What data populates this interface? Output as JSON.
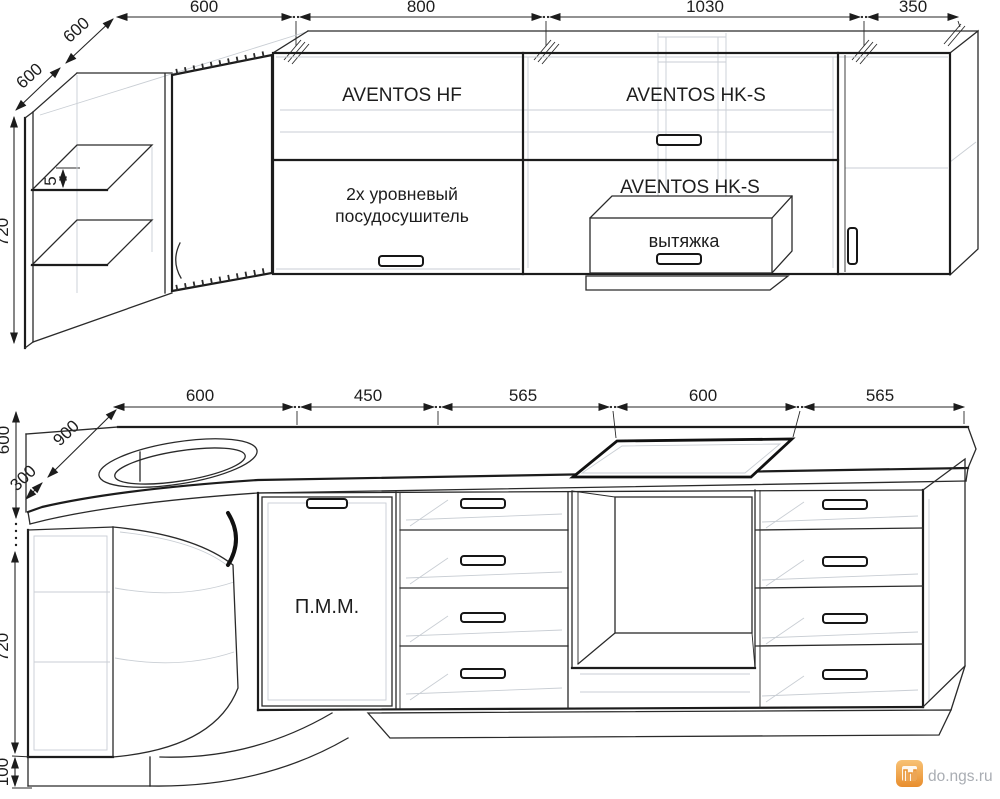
{
  "title": "Kitchen cabinets dimensioned drawing",
  "colors": {
    "line": "#1c1c1c",
    "ghost": "#c9ced4",
    "background": "#ffffff",
    "watermark_orange": "#ec9a3c",
    "watermark_text": "#a9adb3"
  },
  "upper": {
    "dim_top": [
      "600",
      "800",
      "1030",
      "350"
    ],
    "dim_depth": [
      "600",
      "600"
    ],
    "dim_left": {
      "height": "720",
      "shelf_gap": "5"
    },
    "labels": {
      "hf": "AVENTOS HF",
      "hks_top": "AVENTOS HK-S",
      "hks_bottom": "AVENTOS HK-S",
      "dryer_line1": "2х уровневый",
      "dryer_line2": "посудосушитель",
      "hood": "вытяжка"
    }
  },
  "lower": {
    "dim_top": [
      "600",
      "450",
      "565",
      "600",
      "565"
    ],
    "dim_diag": [
      "900",
      "300"
    ],
    "dim_left": {
      "counter_depth": "600",
      "height": "720",
      "plinth": "100"
    },
    "labels": {
      "dishwasher": "П.М.М."
    }
  },
  "watermark": {
    "text": "do.ngs.ru"
  }
}
